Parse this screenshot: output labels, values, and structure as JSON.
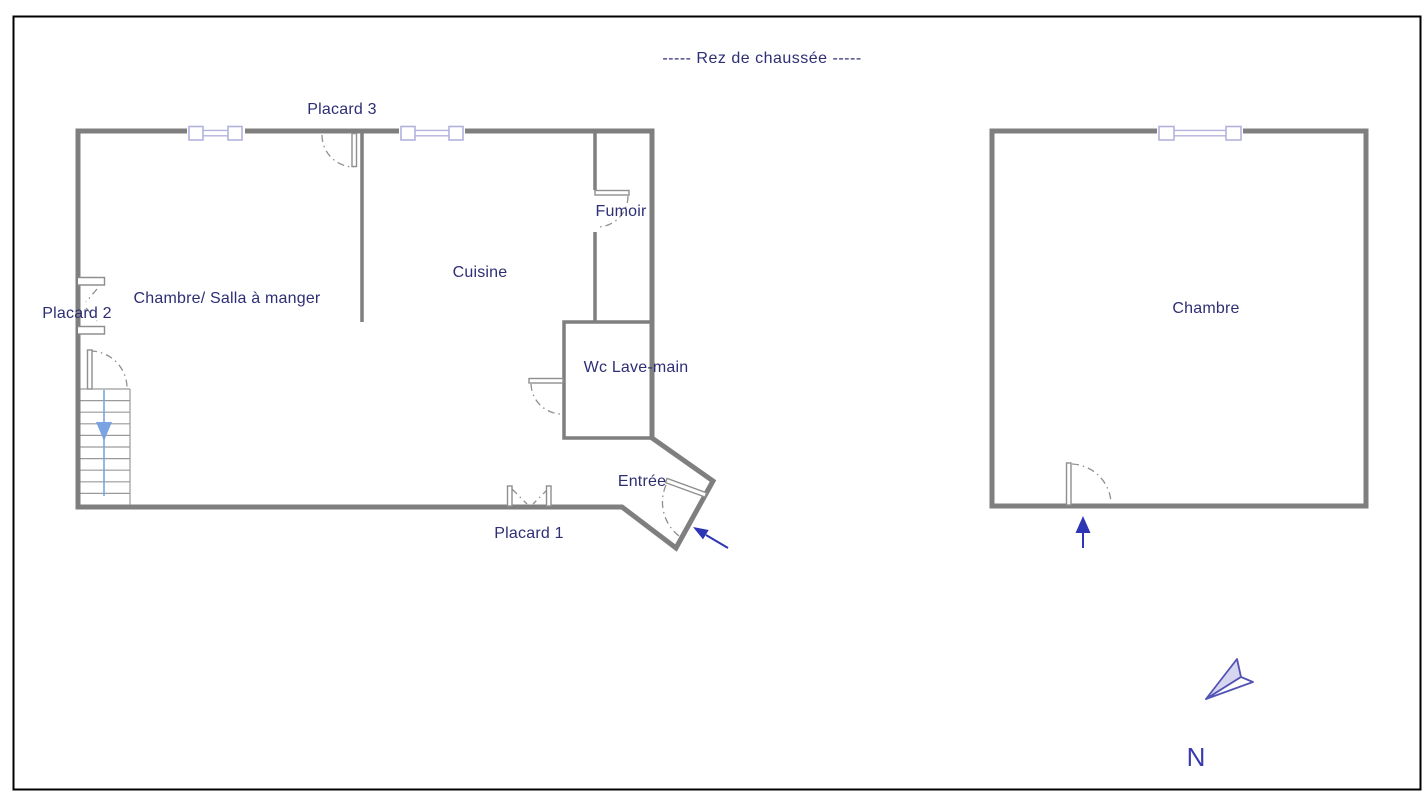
{
  "title": "-----  Rez de chaussée  -----",
  "plan": {
    "left_building": {
      "rooms": {
        "chambre_salle": "Chambre/ Salla à manger",
        "cuisine": "Cuisine",
        "fumoir": "Fumoir",
        "wc": "Wc Lave-main",
        "entree": "Entrée"
      },
      "closets": {
        "placard1": "Placard 1",
        "placard2": "Placard 2",
        "placard3": "Placard 3"
      }
    },
    "right_building": {
      "rooms": {
        "chambre": "Chambre"
      }
    },
    "compass": {
      "north": "N"
    }
  },
  "colors": {
    "wall": "#7f7f7f",
    "text": "#2e2e75",
    "window": "#b2b2dd",
    "door": "#8f8f8f",
    "entry_arrow": "#2d35b5",
    "stairs_arrow": "#7ba3e3",
    "north_icon": "#5353b4",
    "border": "#000000"
  }
}
